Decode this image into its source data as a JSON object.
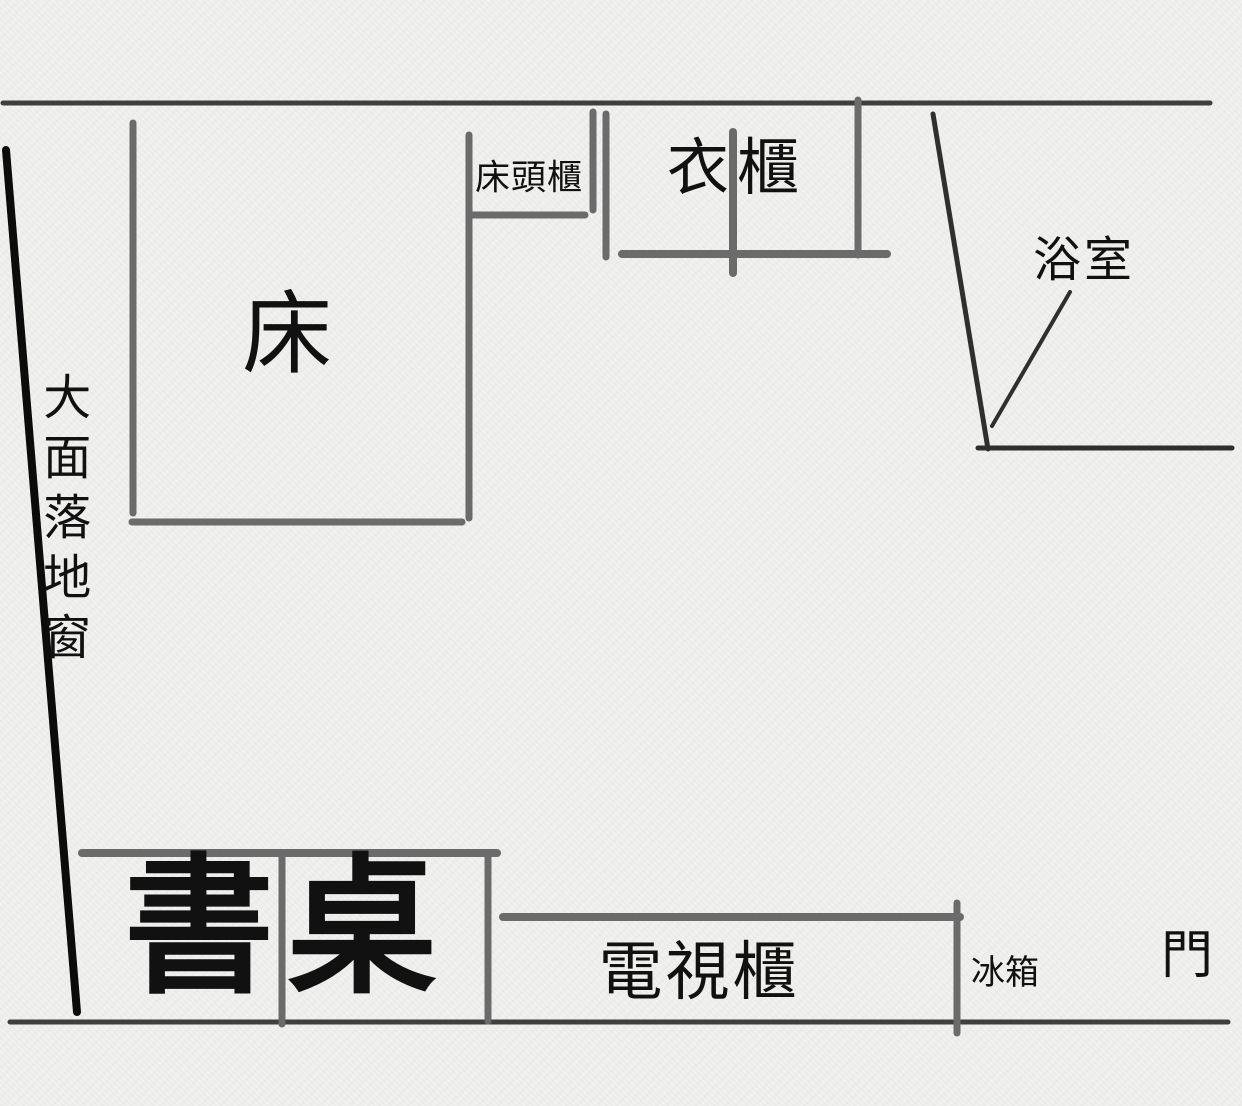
{
  "colors": {
    "background": "#f1f1ef",
    "wall": "#3f3f3f",
    "furniture": "#6b6b6b",
    "window_line": "#0c0c0c",
    "bathroom_line": "#2f2f2f",
    "text": "#111111"
  },
  "floor_plan": {
    "bed_label": "床",
    "nightstand_label": "床頭櫃",
    "wardrobe_label": "衣櫃",
    "bathroom_label": "浴室",
    "window_label": "大面落地窗",
    "desk_label": "書桌",
    "tv_cabinet_label": "電視櫃",
    "fridge_label": "冰箱",
    "door_label": "門"
  }
}
